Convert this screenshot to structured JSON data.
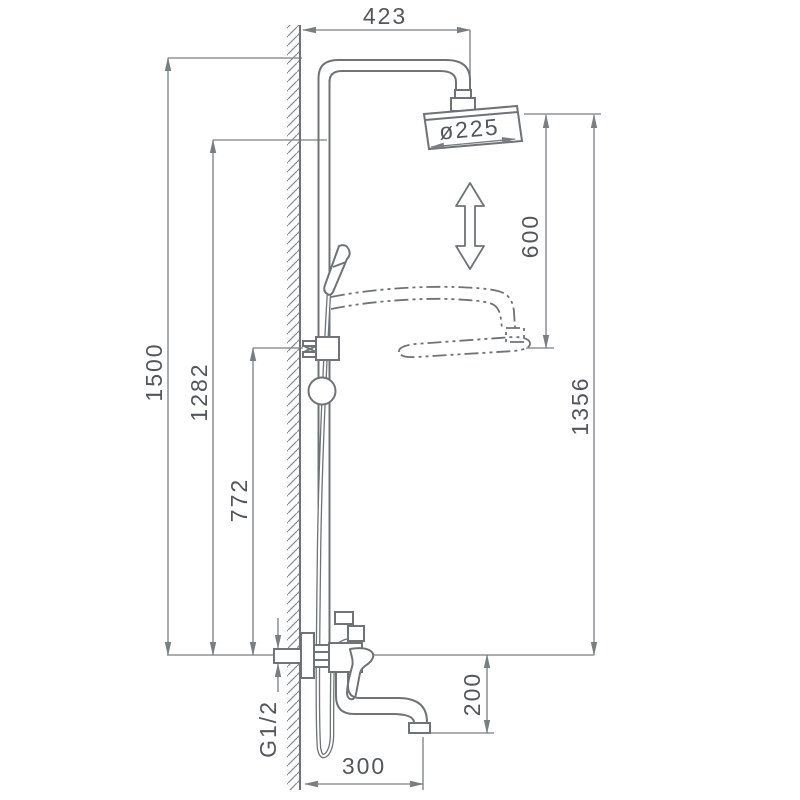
{
  "dimensions": {
    "top_offset": "423",
    "head_diameter": "ø225",
    "height_adjustment": "600",
    "total_height": "1500",
    "upper_outlet_height": "1282",
    "bracket_height": "772",
    "overall_right_height": "1356",
    "spout_drop": "200",
    "spout_reach": "300",
    "inlet_thread": "G1/2"
  },
  "colors": {
    "background": "#ffffff",
    "drawing_line": "#6f7376",
    "dimension_line": "#7a7e81",
    "text": "#53565a"
  }
}
